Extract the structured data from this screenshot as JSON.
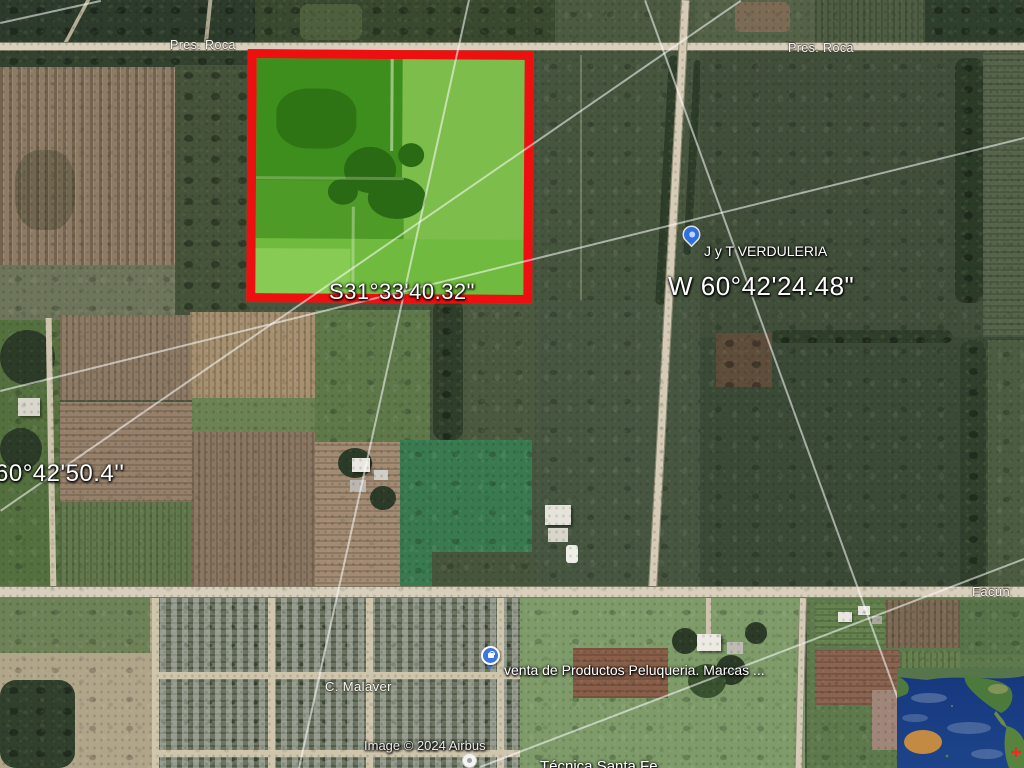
{
  "roads": {
    "pres_roca_left": "Pres. Roca",
    "pres_roca_right": "Pres. Roca",
    "c_malaver": "C. Malaver",
    "facundo_partial": "Facun"
  },
  "places": {
    "verduleria": "J y T VERDULERIA",
    "venta": "venta de Productos Peluqueria. Marcas ...",
    "school_partial": "Técnica Santa Fe"
  },
  "coordinates": {
    "south": "S31°33'40.32\"",
    "west": "W 60°42'24.48\"",
    "west_left": "60°42'50.4''"
  },
  "attribution": "Image © 2024 Airbus",
  "annotation": {
    "parcel_outline_color": "#ee1010",
    "parcel_fill_color": "#59a52c"
  },
  "icons": {
    "verduleria_pin": "map-pin-icon",
    "venta_pin": "store-pin-icon",
    "school_pin": "place-dot-icon",
    "overview_globe": "earth-overview-map"
  }
}
